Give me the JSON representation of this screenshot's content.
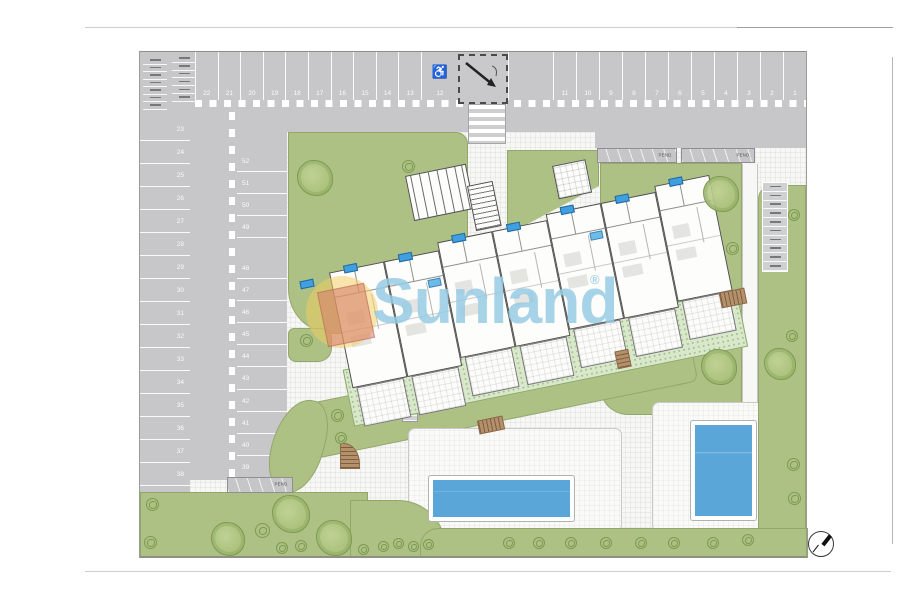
{
  "watermark": {
    "brand": "Sunland",
    "registered": "®"
  },
  "parking": {
    "top_left_numbers": [
      "22",
      "21",
      "20",
      "19",
      "18",
      "17",
      "16",
      "15",
      "14",
      "13"
    ],
    "handicap_number": "12",
    "handicap_icon": "♿",
    "top_right_numbers": [
      "11",
      "10",
      "9",
      "8",
      "7",
      "6",
      "5",
      "4",
      "3",
      "2",
      "1"
    ],
    "left_outer_numbers": [
      "23",
      "24",
      "25",
      "26",
      "27",
      "28",
      "29",
      "30",
      "31",
      "32",
      "33",
      "34",
      "35",
      "36",
      "37",
      "38"
    ],
    "left_inner_upper_numbers": [
      "52",
      "51",
      "50",
      "49"
    ],
    "left_inner_lower_numbers": [
      "48",
      "47",
      "46",
      "45",
      "44",
      "43",
      "42",
      "41",
      "40",
      "39"
    ],
    "moto_corner_col1_slots": 7,
    "moto_corner_col2_slots": 6,
    "bike_rack_right_slots": 10
  },
  "ramps": {
    "label": "PEND."
  },
  "building": {
    "unit_count": 7,
    "unit_top_offsets": [
      20,
      20,
      12,
      12,
      6,
      6,
      0
    ],
    "extra_marker_units": [
      1,
      4
    ]
  },
  "colors": {
    "road": "#c7c7ca",
    "lawn": "#aec184",
    "garden": "#d9e8cb",
    "pool": "#5ba6d8",
    "watermark_blue": "rgba(150,203,227,0.85)",
    "logo_yellow": "rgba(246,206,94,0.5)",
    "logo_red": "rgba(213,122,106,0.55)"
  },
  "landscape": {
    "trees": [
      {
        "x": 297,
        "y": 160,
        "s": 36
      },
      {
        "x": 703,
        "y": 176,
        "s": 36
      },
      {
        "x": 701,
        "y": 349,
        "s": 36
      },
      {
        "x": 764,
        "y": 348,
        "s": 32
      },
      {
        "x": 272,
        "y": 495,
        "s": 38
      },
      {
        "x": 316,
        "y": 520,
        "s": 36
      },
      {
        "x": 211,
        "y": 522,
        "s": 34
      }
    ],
    "bushes": [
      {
        "x": 402,
        "y": 160,
        "s": 13
      },
      {
        "x": 726,
        "y": 242,
        "s": 13
      },
      {
        "x": 788,
        "y": 209,
        "s": 12
      },
      {
        "x": 786,
        "y": 330,
        "s": 12
      },
      {
        "x": 787,
        "y": 458,
        "s": 13
      },
      {
        "x": 788,
        "y": 492,
        "s": 13
      },
      {
        "x": 146,
        "y": 498,
        "s": 13
      },
      {
        "x": 144,
        "y": 536,
        "s": 13
      },
      {
        "x": 255,
        "y": 523,
        "s": 15
      },
      {
        "x": 276,
        "y": 542,
        "s": 12
      },
      {
        "x": 295,
        "y": 540,
        "s": 12
      },
      {
        "x": 358,
        "y": 544,
        "s": 11
      },
      {
        "x": 378,
        "y": 541,
        "s": 11
      },
      {
        "x": 393,
        "y": 538,
        "s": 11
      },
      {
        "x": 408,
        "y": 541,
        "s": 11
      },
      {
        "x": 423,
        "y": 539,
        "s": 11
      },
      {
        "x": 503,
        "y": 537,
        "s": 12
      },
      {
        "x": 533,
        "y": 537,
        "s": 12
      },
      {
        "x": 565,
        "y": 537,
        "s": 12
      },
      {
        "x": 600,
        "y": 537,
        "s": 12
      },
      {
        "x": 635,
        "y": 537,
        "s": 12
      },
      {
        "x": 668,
        "y": 537,
        "s": 12
      },
      {
        "x": 707,
        "y": 537,
        "s": 12
      },
      {
        "x": 742,
        "y": 534,
        "s": 12
      },
      {
        "x": 331,
        "y": 409,
        "s": 13
      },
      {
        "x": 335,
        "y": 432,
        "s": 12
      },
      {
        "x": 300,
        "y": 334,
        "s": 13
      }
    ]
  }
}
